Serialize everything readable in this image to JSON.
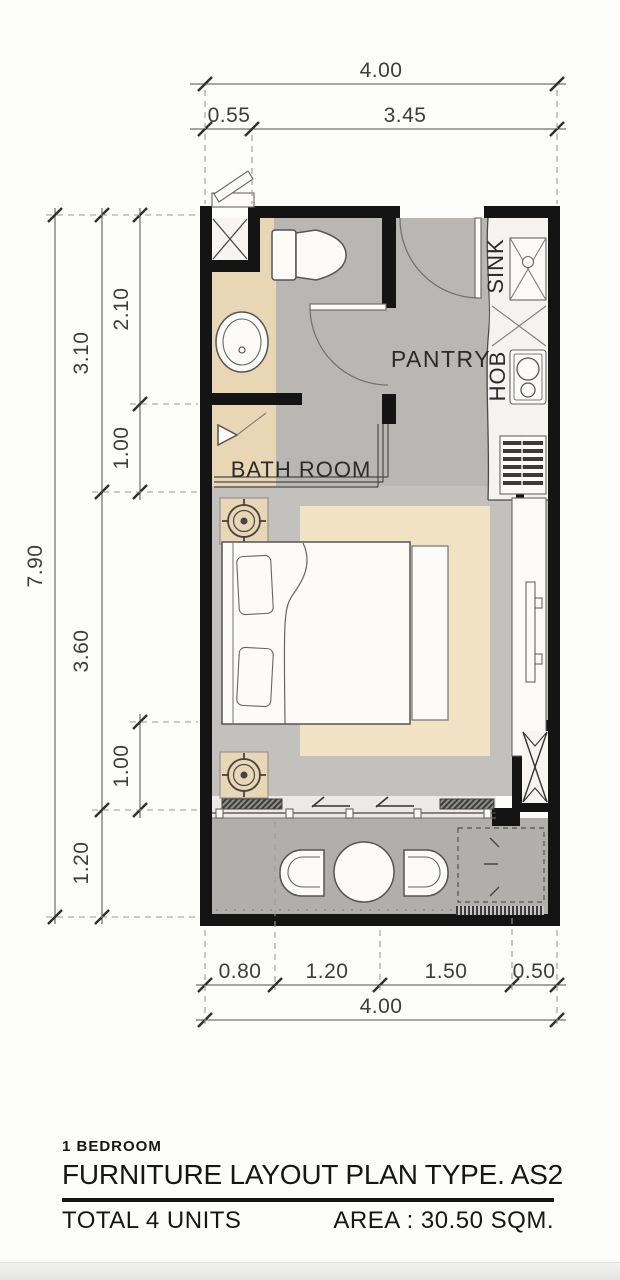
{
  "colors": {
    "wall": "#141414",
    "floor_gray": "#b9b7b4",
    "floor_bedroom": "#c3c1be",
    "floor_balcony": "#b1afac",
    "window_band": "#eceae6",
    "kitchen_counter": "#f4f3f0",
    "counter_tan": "#e9d6b4",
    "rug_tan": "#f2e2c4",
    "shaft_white": "#f6f5f2"
  },
  "plan": {
    "room_labels": {
      "pantry": "PANTRY",
      "bathroom": "BATH ROOM",
      "sink": "SINK",
      "hob": "HOB"
    },
    "dimensions": {
      "top_total": "4.00",
      "top_segments": [
        "0.55",
        "3.45"
      ],
      "left_total": "7.90",
      "left_mid": [
        "3.10",
        "3.60",
        "1.20"
      ],
      "left_inner": [
        "2.10",
        "1.00",
        "1.00"
      ],
      "bottom_segments": [
        "0.80",
        "1.20",
        "1.50",
        "0.50"
      ],
      "bottom_total": "4.00"
    }
  },
  "title_block": {
    "unit_type": "1 BEDROOM",
    "plan_title": "FURNITURE LAYOUT PLAN TYPE. AS2",
    "total_units": "TOTAL 4 UNITS",
    "area": "AREA : 30.50 SQM."
  }
}
